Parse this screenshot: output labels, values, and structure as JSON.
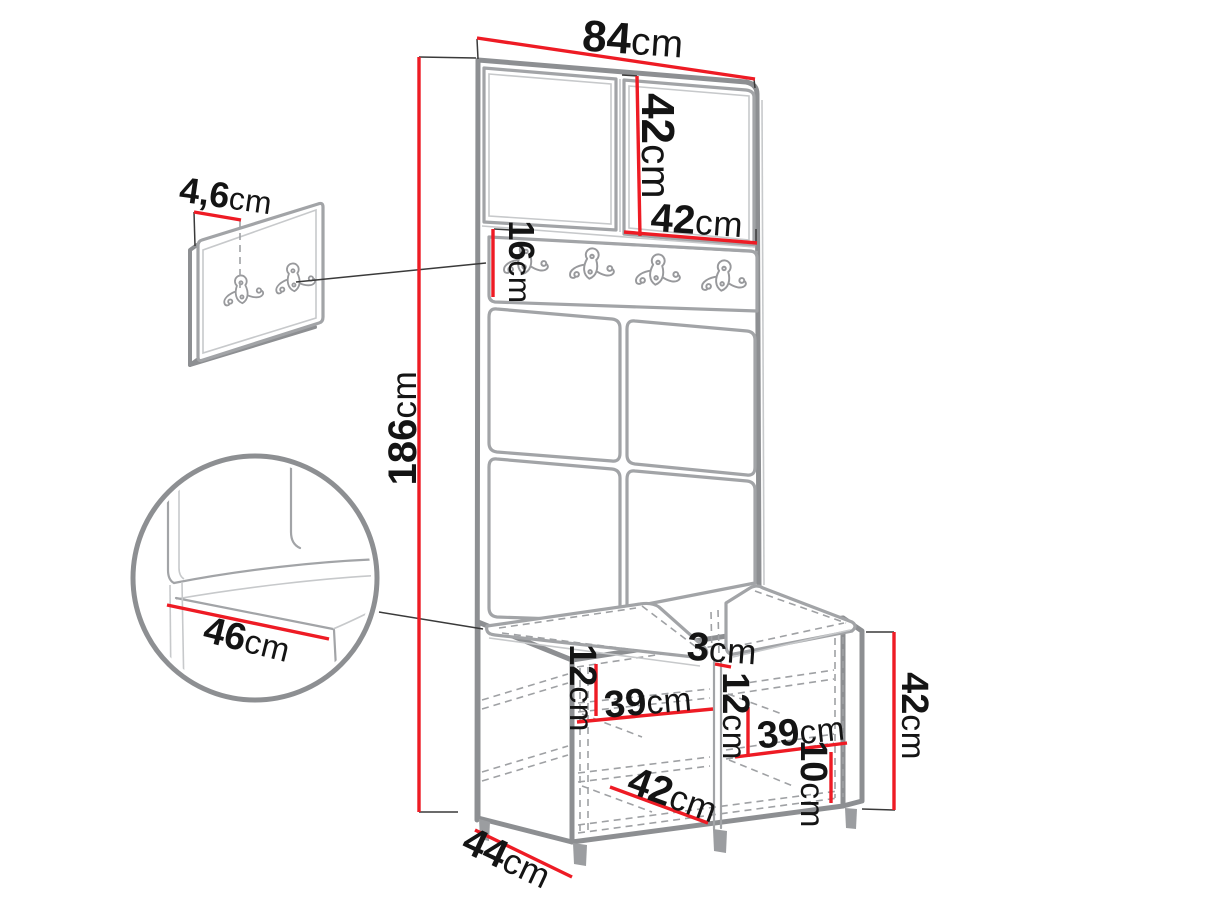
{
  "figure": {
    "description": "Dimension diagram of a hallway furniture set: tall panel with two top cabinets, coat hook rail, four upholstered wall panels and a shoe storage bench with two seat cushions",
    "measurement_unit": "cm",
    "rail_hook_count": 4,
    "detail_panel_hook_count": 2
  },
  "colors": {
    "dimension_line": "#ee1b24",
    "outline_gray": "#8d8f92",
    "dashed_gray": "#9fa1a4",
    "text": "#141414",
    "background": "#ffffff"
  },
  "labels": {
    "overall_width": {
      "value": "84",
      "unit": "cm"
    },
    "top_cabinet_height": {
      "value": "42",
      "unit": "cm"
    },
    "top_cabinet_width": {
      "value": "42",
      "unit": "cm"
    },
    "wall_panel_thickness": {
      "value": "4,6",
      "unit": "cm"
    },
    "hook_rail_height": {
      "value": "16",
      "unit": "cm"
    },
    "total_height": {
      "value": "186",
      "unit": "cm"
    },
    "seat_depth_detail": {
      "value": "46",
      "unit": "cm"
    },
    "center_divider": {
      "value": "3",
      "unit": "cm"
    },
    "left_compartment_height": {
      "value": "12",
      "unit": "cm"
    },
    "left_compartment_width": {
      "value": "39",
      "unit": "cm"
    },
    "right_compartment_height": {
      "value": "12",
      "unit": "cm"
    },
    "right_compartment_width": {
      "value": "39",
      "unit": "cm"
    },
    "bottom_compartment_width": {
      "value": "42",
      "unit": "cm"
    },
    "bottom_compartment_height": {
      "value": "10",
      "unit": "cm"
    },
    "bench_height": {
      "value": "42",
      "unit": "cm"
    },
    "bench_depth": {
      "value": "44",
      "unit": "cm"
    }
  }
}
